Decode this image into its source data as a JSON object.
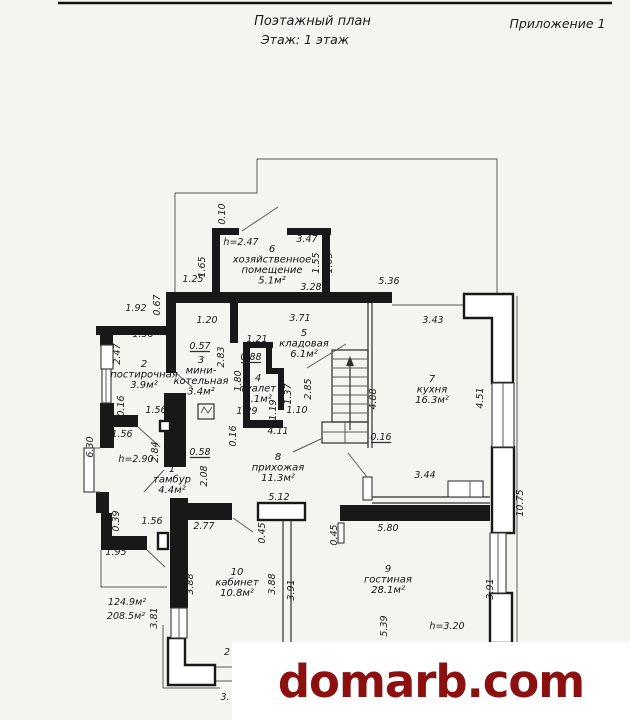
{
  "header": {
    "title": "Поэтажный план",
    "subtitle": "Этаж: 1 этаж",
    "appendix": "Приложение 1"
  },
  "watermark": {
    "text": "domarb.com",
    "color": "#8c1010"
  },
  "plan": {
    "ink_color": "#181818",
    "totals": [
      "124.9м²",
      "208.5м²"
    ],
    "rooms": [
      {
        "id": "room-1-tambur",
        "x": 172,
        "y": 472,
        "lines": [
          "1",
          "тамбур",
          "4.4м²"
        ]
      },
      {
        "id": "room-2-postirochnaya",
        "x": 144,
        "y": 367,
        "lines": [
          "2",
          "постирочная",
          "3.9м²"
        ]
      },
      {
        "id": "room-3-mini-kotelnaya",
        "x": 201,
        "y": 363,
        "lines": [
          "3",
          "мини-",
          "котельная",
          "3.4м²"
        ]
      },
      {
        "id": "room-4-tualet",
        "x": 258,
        "y": 381,
        "lines": [
          "4",
          "туалет",
          "2.1м²"
        ]
      },
      {
        "id": "room-5-kladovaya",
        "x": 304,
        "y": 336,
        "lines": [
          "5",
          "кладовая",
          "6.1м²"
        ]
      },
      {
        "id": "room-6-khozpomeshchenie",
        "x": 272,
        "y": 252,
        "lines": [
          "6",
          "хозяйственное",
          "помещение",
          "5.1м²"
        ]
      },
      {
        "id": "room-7-kukhnya",
        "x": 432,
        "y": 382,
        "lines": [
          "7",
          "кухня",
          "16.3м²"
        ]
      },
      {
        "id": "room-8-prikhozhaya",
        "x": 278,
        "y": 460,
        "lines": [
          "8",
          "прихожая",
          "11.3м²"
        ]
      },
      {
        "id": "room-9-gostinaya",
        "x": 388,
        "y": 572,
        "lines": [
          "9",
          "гостиная",
          "28.1м²"
        ]
      },
      {
        "id": "room-10-kabinet",
        "x": 237,
        "y": 575,
        "lines": [
          "10",
          "кабинет",
          "10.8м²"
        ]
      }
    ],
    "dims": [
      {
        "t": "0.10",
        "x": 225,
        "y": 214,
        "v": 1
      },
      {
        "t": "3.47",
        "x": 307,
        "y": 242
      },
      {
        "t": "h=2.47",
        "x": 241,
        "y": 245,
        "s": 10.5,
        "n": "height-note"
      },
      {
        "t": "1.65",
        "x": 205,
        "y": 267,
        "v": 1
      },
      {
        "t": "1.55",
        "x": 319,
        "y": 263,
        "v": 1
      },
      {
        "t": "1.65",
        "x": 332,
        "y": 263,
        "v": 1
      },
      {
        "t": "1.25",
        "x": 193,
        "y": 282
      },
      {
        "t": "3.28",
        "x": 311,
        "y": 290
      },
      {
        "t": "5.36",
        "x": 389,
        "y": 284
      },
      {
        "t": "1.92",
        "x": 136,
        "y": 311
      },
      {
        "t": "0.67",
        "x": 160,
        "y": 305,
        "v": 1
      },
      {
        "t": "1.56",
        "x": 143,
        "y": 337
      },
      {
        "t": "1.20",
        "x": 207,
        "y": 323
      },
      {
        "t": "0.87",
        "x": 238,
        "y": 328,
        "v": 1
      },
      {
        "t": "3.71",
        "x": 300,
        "y": 321
      },
      {
        "t": "3.43",
        "x": 433,
        "y": 323
      },
      {
        "t": "2.47",
        "x": 120,
        "y": 354,
        "v": 1
      },
      {
        "t": "0.57",
        "x": 200,
        "y": 349,
        "u": 1
      },
      {
        "t": "1.21",
        "x": 257,
        "y": 342
      },
      {
        "t": "2.83",
        "x": 224,
        "y": 357,
        "v": 1
      },
      {
        "t": "0.88",
        "x": 251,
        "y": 360,
        "u": 1
      },
      {
        "t": "1.80",
        "x": 241,
        "y": 381,
        "v": 1
      },
      {
        "t": "1.37",
        "x": 291,
        "y": 394,
        "v": 1
      },
      {
        "t": "2.85",
        "x": 311,
        "y": 389,
        "v": 1
      },
      {
        "t": "4.88",
        "x": 376,
        "y": 399,
        "v": 1
      },
      {
        "t": "4.51",
        "x": 483,
        "y": 398,
        "v": 1
      },
      {
        "t": "0.16",
        "x": 124,
        "y": 406,
        "v": 1
      },
      {
        "t": "1.56",
        "x": 156,
        "y": 413
      },
      {
        "t": "1.29",
        "x": 247,
        "y": 414
      },
      {
        "t": "1.19",
        "x": 276,
        "y": 410,
        "v": 1
      },
      {
        "t": "1.10",
        "x": 297,
        "y": 413
      },
      {
        "t": "4.11",
        "x": 278,
        "y": 434
      },
      {
        "t": "0.16",
        "x": 236,
        "y": 436,
        "v": 1
      },
      {
        "t": "0.16",
        "x": 381,
        "y": 440,
        "u": 1
      },
      {
        "t": "1.56",
        "x": 122,
        "y": 437
      },
      {
        "t": "6.30",
        "x": 93,
        "y": 447,
        "v": 1
      },
      {
        "t": "2.84",
        "x": 158,
        "y": 452,
        "v": 1
      },
      {
        "t": "0.58",
        "x": 200,
        "y": 455,
        "u": 1
      },
      {
        "t": "h=2.90",
        "x": 136,
        "y": 462,
        "s": 10.5,
        "n": "height-note"
      },
      {
        "t": "2.08",
        "x": 207,
        "y": 476,
        "v": 1
      },
      {
        "t": "5.12",
        "x": 279,
        "y": 500
      },
      {
        "t": "0.39",
        "x": 119,
        "y": 521,
        "v": 1
      },
      {
        "t": "1.56",
        "x": 152,
        "y": 524
      },
      {
        "t": "1.95",
        "x": 116,
        "y": 555
      },
      {
        "t": "2.77",
        "x": 204,
        "y": 529
      },
      {
        "t": "0.45",
        "x": 265,
        "y": 533,
        "v": 1
      },
      {
        "t": "0.45",
        "x": 337,
        "y": 535,
        "v": 1
      },
      {
        "t": "5.80",
        "x": 388,
        "y": 531
      },
      {
        "t": "3.44",
        "x": 425,
        "y": 478
      },
      {
        "t": "10.75",
        "x": 523,
        "y": 503,
        "v": 1
      },
      {
        "t": "3.88",
        "x": 193,
        "y": 584,
        "v": 1
      },
      {
        "t": "3.88",
        "x": 275,
        "y": 584,
        "v": 1
      },
      {
        "t": "3.91",
        "x": 294,
        "y": 590,
        "v": 1
      },
      {
        "t": "3.91",
        "x": 493,
        "y": 589,
        "v": 1
      },
      {
        "t": "5.39",
        "x": 387,
        "y": 626,
        "v": 1
      },
      {
        "t": "3.81",
        "x": 157,
        "y": 618,
        "v": 1
      },
      {
        "t": "h=3.20",
        "x": 447,
        "y": 629,
        "s": 10.5,
        "n": "height-note"
      },
      {
        "t": "124.9м²",
        "x": 127,
        "y": 605,
        "s": 10.5,
        "n": "total-area-label"
      },
      {
        "t": "208.5м²",
        "x": 126,
        "y": 619,
        "s": 10.5,
        "n": "total-area-label"
      },
      {
        "t": "2",
        "x": 227,
        "y": 655
      },
      {
        "t": "3.",
        "x": 225,
        "y": 700
      }
    ]
  }
}
